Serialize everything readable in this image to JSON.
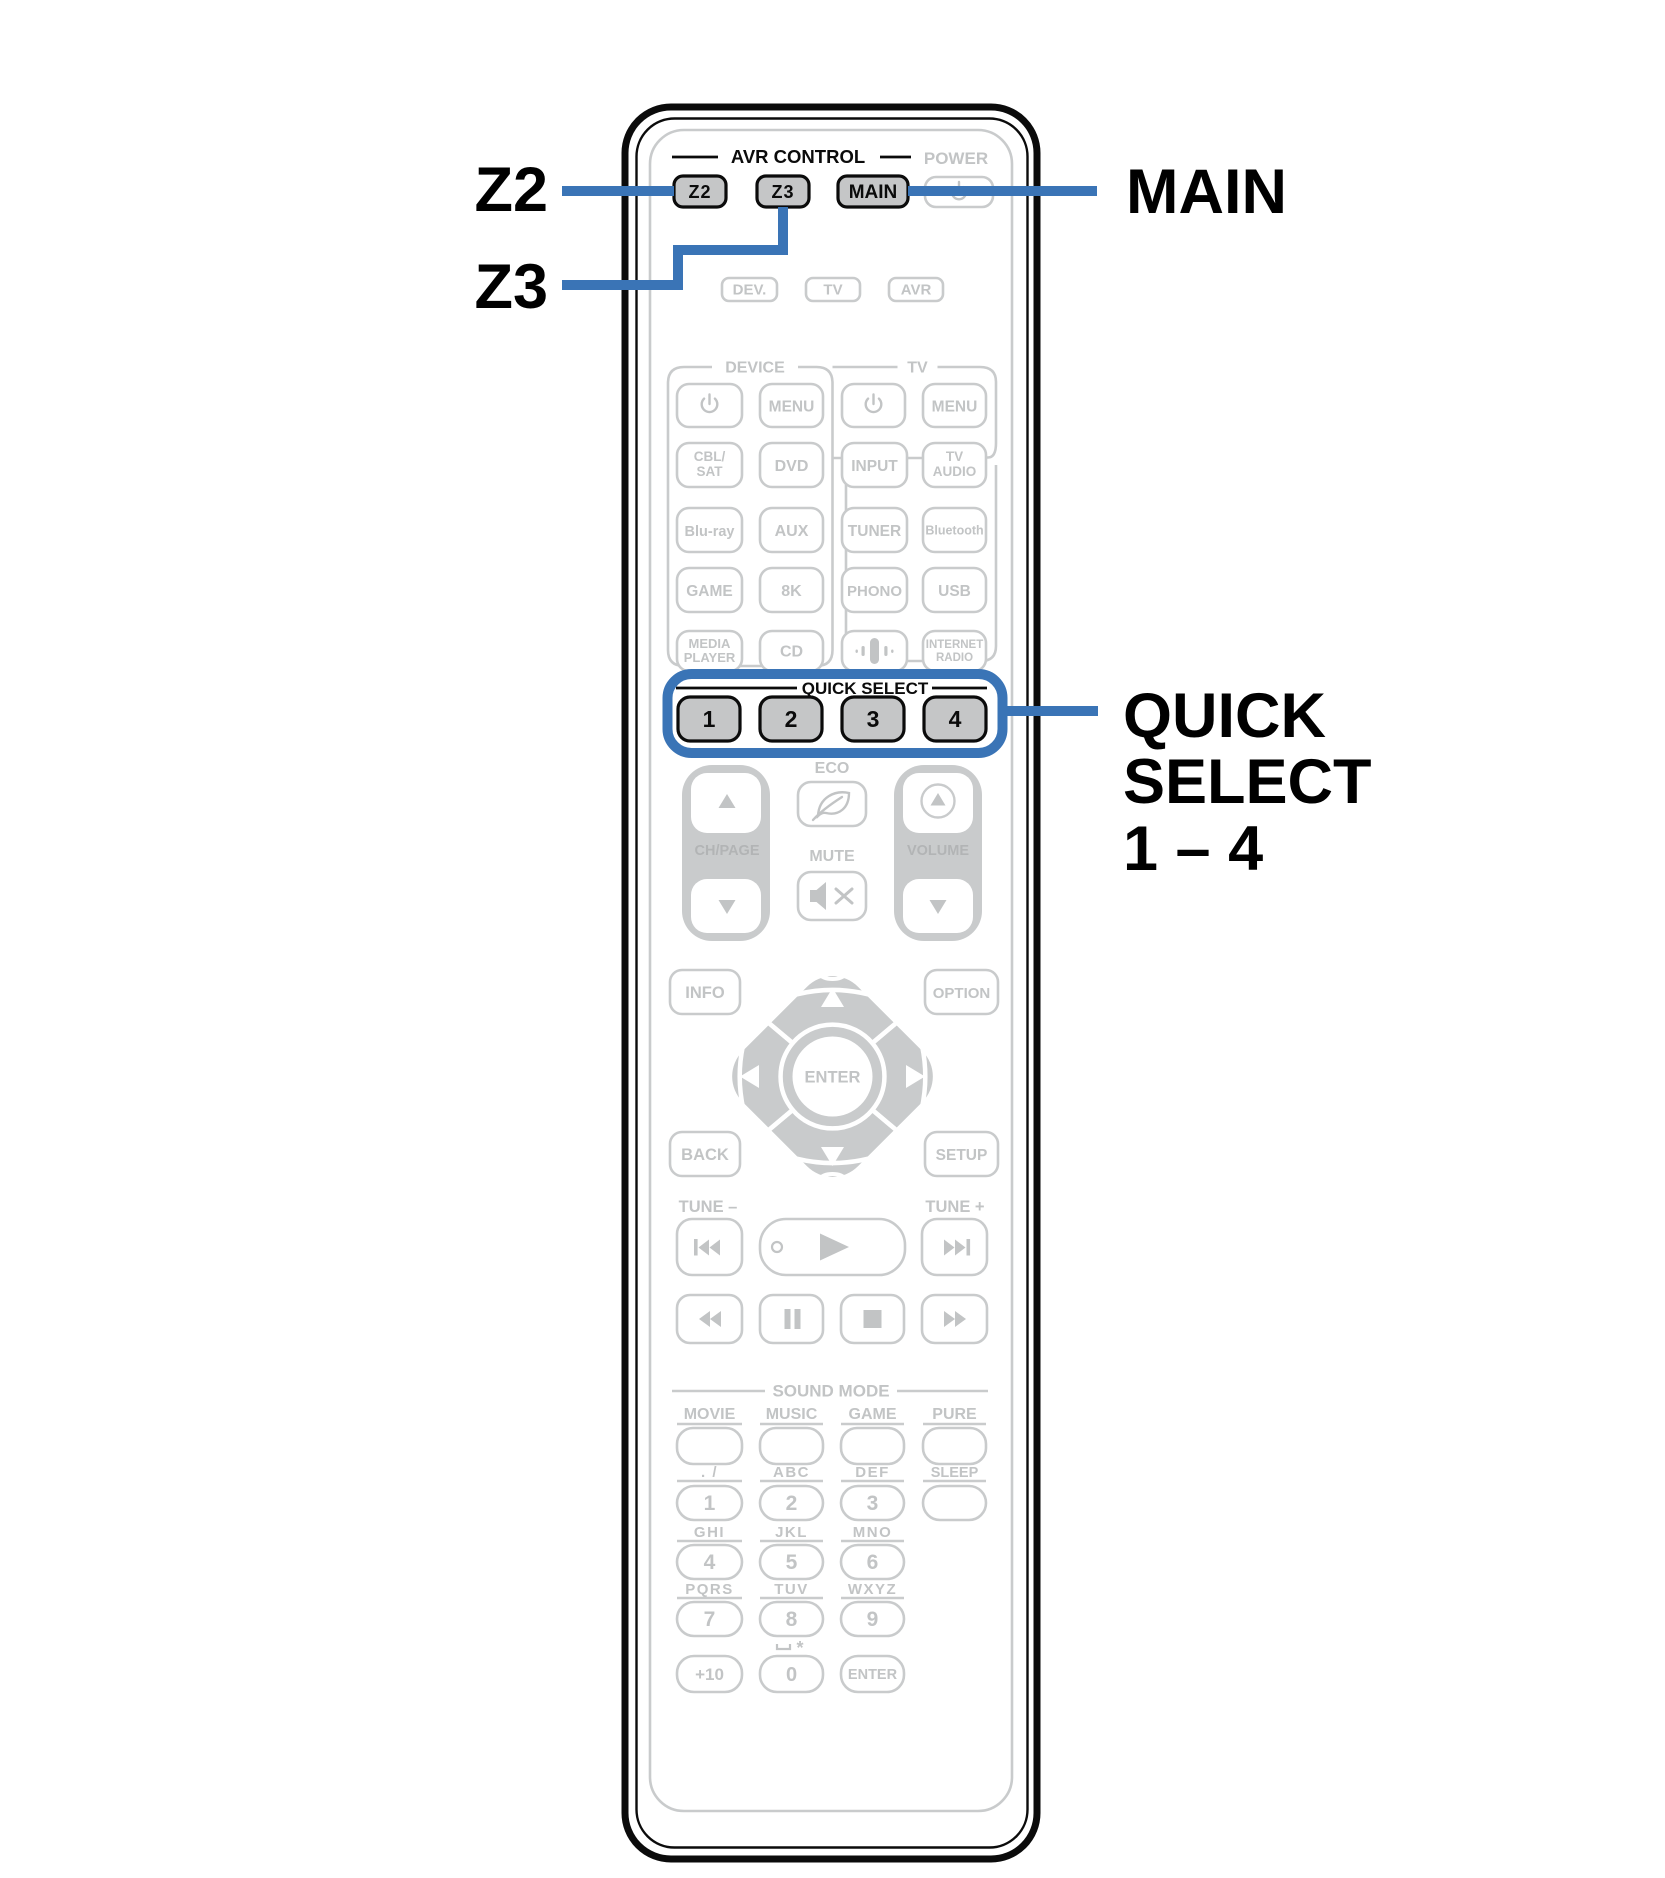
{
  "colors": {
    "accent_blue": "#3a74b6",
    "inactive_gray": "#c9cbcc",
    "highlight_button_fill": "#c5c6c7",
    "outline_black": "#0b0b0b"
  },
  "callouts": {
    "z2": "Z2",
    "z3": "Z3",
    "main": "MAIN",
    "quick_line1": "QUICK",
    "quick_line2": "SELECT",
    "quick_line3": "1 – 4"
  },
  "header": {
    "avr_control": "AVR CONTROL",
    "power": "POWER",
    "z2": "Z2",
    "z3": "Z3",
    "main": "MAIN"
  },
  "mode": {
    "dev": "DEV.",
    "tv": "TV",
    "avr": "AVR"
  },
  "device": {
    "label": "DEVICE",
    "menu": "MENU",
    "cbl1": "CBL/",
    "cbl2": "SAT",
    "dvd": "DVD",
    "bluray": "Blu-ray",
    "aux": "AUX",
    "game": "GAME",
    "k8": "8K",
    "media1": "MEDIA",
    "media2": "PLAYER",
    "cd": "CD"
  },
  "tv": {
    "label": "TV",
    "menu": "MENU",
    "input": "INPUT",
    "tvaudio1": "TV",
    "tvaudio2": "AUDIO",
    "tuner": "TUNER",
    "bluetooth": "Bluetooth",
    "phono": "PHONO",
    "usb": "USB",
    "internet1": "INTERNET",
    "internet2": "RADIO"
  },
  "quick": {
    "label": "QUICK SELECT",
    "b1": "1",
    "b2": "2",
    "b3": "3",
    "b4": "4"
  },
  "volume_zone": {
    "eco": "ECO",
    "mute": "MUTE",
    "chpage": "CH/PAGE",
    "volume": "VOLUME"
  },
  "nav": {
    "info": "INFO",
    "option": "OPTION",
    "back": "BACK",
    "setup": "SETUP",
    "enter": "ENTER"
  },
  "tune": {
    "minus": "TUNE –",
    "plus": "TUNE +"
  },
  "sound": {
    "label": "SOUND MODE",
    "movie": "MOVIE",
    "music": "MUSIC",
    "game": "GAME",
    "pure": "PURE"
  },
  "keypad": {
    "l1": ". /",
    "l2": "ABC",
    "l3": "DEF",
    "sleep": "SLEEP",
    "k1": "1",
    "k2": "2",
    "k3": "3",
    "l4": "GHI",
    "l5": "JKL",
    "l6": "MNO",
    "k4": "4",
    "k5": "5",
    "k6": "6",
    "l7": "PQRS",
    "l8": "TUV",
    "l9": "WXYZ",
    "k7": "7",
    "k8": "8",
    "k9": "9",
    "star": "*",
    "plus10": "+10",
    "k0": "0",
    "enter": "ENTER"
  }
}
